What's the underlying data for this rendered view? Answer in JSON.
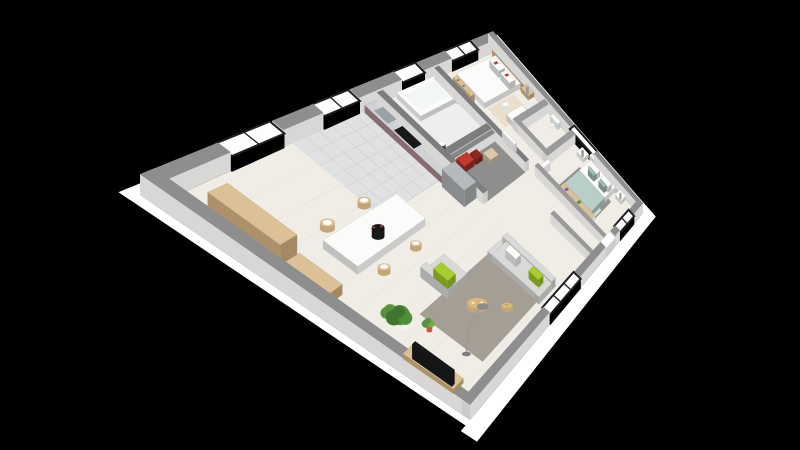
{
  "scene": {
    "kind": "3d-floor-plan-render",
    "view": "isometric-top-down",
    "background": "#000000",
    "rooms": [
      {
        "name": "living-dining",
        "furniture": [
          "dining-table",
          "dining-chairs-x4",
          "tableware",
          "serving-tray",
          "tall-bookshelf",
          "storage-cabinet",
          "potted-plant-large",
          "potted-plant-small",
          "tv-sideboard",
          "tv",
          "armchair",
          "sofa",
          "lime-pillows",
          "area-rug",
          "round-coffee-table-large",
          "round-coffee-table-small",
          "arc-floor-lamp",
          "sliding-glass-door"
        ]
      },
      {
        "name": "kitchen",
        "furniture": [
          "counter-with-sink",
          "cooktop",
          "extractor-column",
          "tall-cabinet",
          "tiled-floor",
          "glazed-door"
        ]
      },
      {
        "name": "bathroom",
        "furniture": [
          "bathtub",
          "glass-screen",
          "washbasin",
          "window"
        ]
      },
      {
        "name": "closet",
        "furniture": [
          "hanging-clothes-red",
          "garment-dark",
          "bag-beige"
        ]
      },
      {
        "name": "hallway",
        "furniture": [
          "doors-white"
        ]
      },
      {
        "name": "bedroom-1",
        "furniture": [
          "double-bed-white",
          "pillows-red-stripe",
          "wood-headboard",
          "nightstand",
          "table-lamp",
          "desk",
          "desk-chair",
          "bookshelf-with-books",
          "patterned-rug",
          "window"
        ]
      },
      {
        "name": "wc",
        "furniture": [
          "toilet"
        ]
      },
      {
        "name": "bedroom-2",
        "furniture": [
          "double-bed-sage",
          "white-pillows",
          "teal-pillows",
          "headboard-white",
          "nightstand-north",
          "nightstand-south",
          "table-lamps",
          "console-desk",
          "plants",
          "gray-rug",
          "throw-blanket",
          "window-south",
          "window-east"
        ]
      },
      {
        "name": "entrance",
        "furniture": [
          "front-door"
        ]
      }
    ],
    "palette": {
      "bg": "#000000",
      "slab": "#ffffff",
      "wallTop": "#8e8e8e",
      "wallSide": "#f5f4f2",
      "intWallTop": "#9a9a9a",
      "blockTop": "#7d7d7d",
      "closetWall": "#868686",
      "floorWood": "#f0ede6",
      "plankLine": "#e4dfd6",
      "floorTile": "#e0e1e2",
      "tileLine": "#cbcdce",
      "floorBath": "#edefef",
      "floorCloset": "#8e8e8c",
      "rugLiving": "#a59e95",
      "rugBed1": "#e9dfcb",
      "rugBed2": "#95938f",
      "throw": "#cfe0d9",
      "sofa": "#d9d9d7",
      "sofaSide": "#c2c2c0",
      "lime": "#a6ce2e",
      "white": "#fbfbfa",
      "tableSide": "#e6e6e4",
      "duvetSide": "#e8e8e6",
      "woodLight": "#dcc096",
      "woodSide": "#c4a578",
      "woodTable": "#d9b87f",
      "steel": "#ced2d4",
      "mauve": "#9b7a80",
      "sinkGray": "#9aa0a3",
      "hoodGray": "#8d9092",
      "cabinetGray": "#b7babc",
      "cabinetSide": "#9c9fa1",
      "black": "#17181a",
      "red": "#c23b32",
      "darkRed": "#8e2a24",
      "bagBeige": "#d9c9a8",
      "sage": "#b9cec6",
      "sageSide": "#a3bcb2",
      "sageDark": "#9fbdb2",
      "headboard2": "#f2f2f1",
      "headboardSide": "#dcdcda",
      "nsSide": "#e2e2e0",
      "lampGray": "#9b9b9b",
      "glass": "#fdfdfd",
      "frame": "#1f1f1f",
      "glassScreen": "#dce9ec",
      "tubSide": "#e4e6e6",
      "tubInner": "#f3f6f6",
      "basinDark": "#3c3c3e",
      "toiletSide": "#e6e8e8",
      "chairSide": "#e0e0de",
      "potWhite": "#f2f2f0",
      "potOrange": "#cc5a35",
      "green1": "#4e8f3a",
      "green2": "#6fae4e",
      "purple": "#9b59b6",
      "blue": "#3a6bc4",
      "yellow": "#d8b43a",
      "doorSide": "#e9e9e7"
    }
  }
}
